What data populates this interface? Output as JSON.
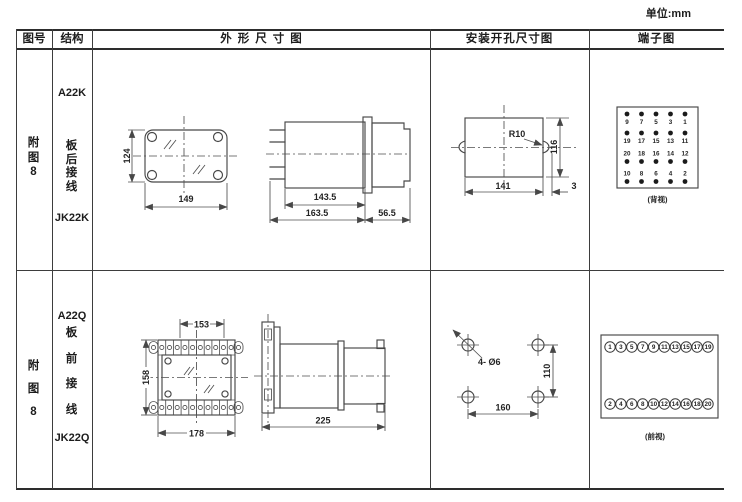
{
  "unit_label": "单位:mm",
  "header": {
    "figure": "图号",
    "structure": "结构",
    "outline": "外形尺寸图",
    "mounting": "安装开孔尺寸图",
    "terminal": "端子图"
  },
  "rows": [
    {
      "figure_no": "附图8",
      "structure": {
        "model": "A22K",
        "wiring": "板后接线",
        "socket": "JK22K"
      },
      "outline_front": {
        "height": "124",
        "width": "149"
      },
      "outline_side": {
        "body_length": "143.5",
        "total_length": "163.5",
        "depth": "56.5"
      },
      "mounting": {
        "radius": "R10",
        "width": "141",
        "edge": "3",
        "height": "116"
      },
      "terminal": {
        "caption": "(背视)",
        "groups": [
          {
            "labels": [
              "9",
              "7",
              "5",
              "3",
              "1"
            ]
          },
          {
            "labels": [
              "19",
              "17",
              "15",
              "13",
              "11"
            ]
          },
          {
            "labels": [
              "20",
              "18",
              "16",
              "14",
              "12"
            ]
          },
          {
            "labels": [
              "10",
              "8",
              "6",
              "4",
              "2"
            ]
          }
        ]
      }
    },
    {
      "figure_no": "附图8",
      "structure": {
        "model": "A22Q",
        "wiring": "板前接线",
        "socket": "JK22Q"
      },
      "outline_front": {
        "top_width": "153",
        "height": "158",
        "width": "178"
      },
      "outline_side": {
        "length": "225"
      },
      "mounting": {
        "holes": "4- Ø6",
        "height": "110",
        "width": "160"
      },
      "terminal": {
        "caption": "(前视)",
        "top": [
          "1",
          "3",
          "5",
          "7",
          "9",
          "11",
          "13",
          "15",
          "17",
          "19"
        ],
        "bottom": [
          "2",
          "4",
          "6",
          "8",
          "10",
          "12",
          "14",
          "16",
          "18",
          "20"
        ]
      }
    }
  ],
  "colors": {
    "line": "#474747",
    "text": "#222222",
    "background": "#ffffff"
  }
}
